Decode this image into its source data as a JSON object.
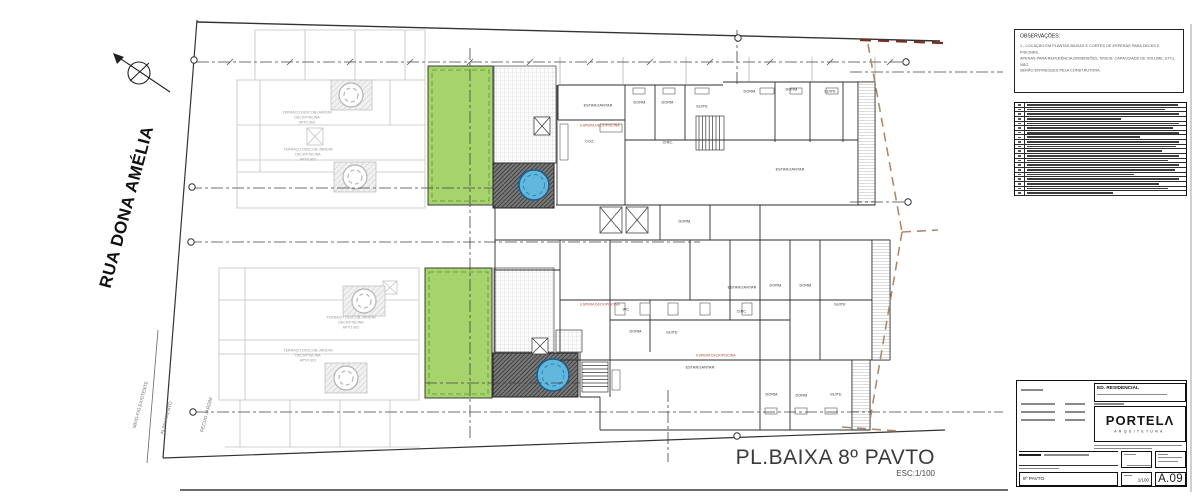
{
  "colors": {
    "green": "#a6d36b",
    "pool": "#62b8dc",
    "deck_dark": "#787878",
    "boundary_brown": "#b08968",
    "boundary_red": "#7a2f20"
  },
  "drawing": {
    "title": "PL.BAIXA 8º PAVTO",
    "scale": "ESC:1/100",
    "street_label": "RUA DONA AMÉLIA",
    "site_labels": {
      "curb": "MEIO-FIO EXISTENTE",
      "alignment": "ALINHAMENTO",
      "setback": "RECUO JARDIM"
    },
    "terrace_labels": [
      {
        "x": 307,
        "y": 118,
        "lines": [
          "TERRAÇO DESCOB./JARDIM",
          "DECK/PISCINA",
          "APTO 802"
        ]
      },
      {
        "x": 308,
        "y": 155,
        "lines": [
          "TERRAÇO DESCOB./JARDIM",
          "DECK/PISCINA",
          "APTO 801"
        ]
      },
      {
        "x": 351,
        "y": 323,
        "lines": [
          "TERRAÇO DESCOB./JARDIM",
          "DECK/PISCINA",
          "APTO 802"
        ]
      },
      {
        "x": 308,
        "y": 356,
        "lines": [
          "TERRAÇO DESCOB./JARDIM",
          "DECK/PISCINA",
          "APTO 801"
        ]
      }
    ],
    "room_labels": [
      {
        "text": "ESTAR/JANTAR",
        "x": 598,
        "y": 106
      },
      {
        "text": "DORM.",
        "x": 640,
        "y": 103
      },
      {
        "text": "DORM.",
        "x": 668,
        "y": 103
      },
      {
        "text": "SUITE",
        "x": 702,
        "y": 107
      },
      {
        "text": "DORM.",
        "x": 750,
        "y": 92
      },
      {
        "text": "DORM.",
        "x": 792,
        "y": 90
      },
      {
        "text": "SUITE",
        "x": 830,
        "y": 92
      },
      {
        "text": "COZ.",
        "x": 590,
        "y": 142
      },
      {
        "text": "CIRC.",
        "x": 668,
        "y": 143
      },
      {
        "text": "ESTAR/JANTAR",
        "x": 790,
        "y": 170
      },
      {
        "text": "DORM.",
        "x": 685,
        "y": 222
      },
      {
        "text": "ESTAR/JANTAR",
        "x": 742,
        "y": 288
      },
      {
        "text": "DORM.",
        "x": 776,
        "y": 286
      },
      {
        "text": "DORM.",
        "x": 806,
        "y": 286
      },
      {
        "text": "SUITE",
        "x": 840,
        "y": 305
      },
      {
        "text": "CIRC.",
        "x": 742,
        "y": 312
      },
      {
        "text": "WC",
        "x": 626,
        "y": 310
      },
      {
        "text": "DORM.",
        "x": 636,
        "y": 332
      },
      {
        "text": "SUITE",
        "x": 672,
        "y": 333
      },
      {
        "text": "ESTAR/JANTAR",
        "x": 700,
        "y": 368
      },
      {
        "text": "DORM.",
        "x": 772,
        "y": 395
      },
      {
        "text": "DORM.",
        "x": 802,
        "y": 396
      },
      {
        "text": "SUITE",
        "x": 836,
        "y": 395
      }
    ],
    "note_labels": [
      {
        "x": 600,
        "y": 126,
        "text": "ESPERA DECK/PISCINA"
      },
      {
        "x": 600,
        "y": 305,
        "text": "ESPERA DECK/PISCINA"
      },
      {
        "x": 716,
        "y": 356,
        "text": "ESPERA DECK/PISCINA"
      }
    ]
  },
  "observations": {
    "title": "OBSERVAÇÕES:",
    "lines": [
      "1 - LOCAÇÃO EM PLANTAS BAIXAS E CORTES DE ESPERAS PARA DECKS E PISCINAS,",
      "APENAS PARA REFERÊNCIA (DIMENSÕES, NIVEIS, CAPACIDADE DE VOLUME, ETC). NÃO",
      "SERÃO ENTREGUES PELA CONSTRUTORA."
    ]
  },
  "revisions": {
    "row_count": 20
  },
  "title_block": {
    "building": "ED. RESIDENCIAL",
    "logo_word": "PORTELΛ",
    "logo_sub": "ARQUITETURA",
    "pavto": "8º PAVTO",
    "scale_value": "1/100",
    "sheet_number": "A.09"
  }
}
